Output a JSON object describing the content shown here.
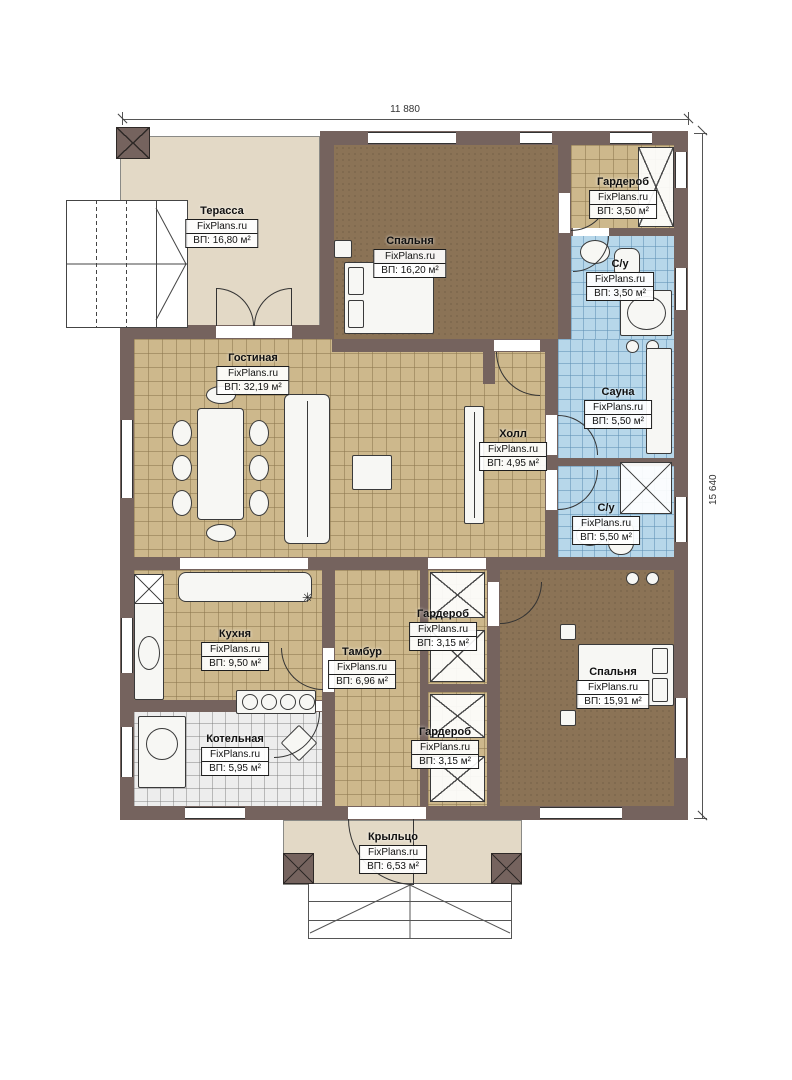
{
  "watermark": "FixPlans.ru",
  "dimensions": {
    "width_label": "11 880",
    "height_label": "15 640"
  },
  "rooms": [
    {
      "id": "terrace",
      "name": "Терасса",
      "area": "ВП: 16,80 м²"
    },
    {
      "id": "bedroom-top",
      "name": "Спальня",
      "area": "ВП: 16,20 м²"
    },
    {
      "id": "wardrobe-top",
      "name": "Гардероб",
      "area": "ВП: 3,50 м²"
    },
    {
      "id": "bathroom-top",
      "name": "С/у",
      "area": "ВП: 3,50 м²"
    },
    {
      "id": "living",
      "name": "Гостиная",
      "area": "ВП: 32,19 м²"
    },
    {
      "id": "hall",
      "name": "Холл",
      "area": "ВП: 4,95 м²"
    },
    {
      "id": "sauna",
      "name": "Сауна",
      "area": "ВП: 5,50 м²"
    },
    {
      "id": "bathroom-mid",
      "name": "С/у",
      "area": "ВП: 5,50 м²"
    },
    {
      "id": "kitchen",
      "name": "Кухня",
      "area": "ВП: 9,50 м²"
    },
    {
      "id": "tambour",
      "name": "Тамбур",
      "area": "ВП: 6,96 м²"
    },
    {
      "id": "wardrobe-mid",
      "name": "Гардероб",
      "area": "ВП: 3,15 м²"
    },
    {
      "id": "bedroom-bottom",
      "name": "Спальня",
      "area": "ВП: 15,91 м²"
    },
    {
      "id": "wardrobe-bottom",
      "name": "Гардероб",
      "area": "ВП: 3,15 м²"
    },
    {
      "id": "boiler",
      "name": "Котельная",
      "area": "ВП: 5,95 м²"
    },
    {
      "id": "porch",
      "name": "Крыльцо",
      "area": "ВП: 6,53 м²"
    }
  ],
  "symbols": {
    "vent": "✳"
  },
  "colors": {
    "wall": "#75635e",
    "floor_tan": "#cdb88c",
    "floor_blue": "#b7d7ea",
    "floor_brown": "#8b7356",
    "floor_beige": "#e3d9c6",
    "floor_tile": "#ededed"
  }
}
